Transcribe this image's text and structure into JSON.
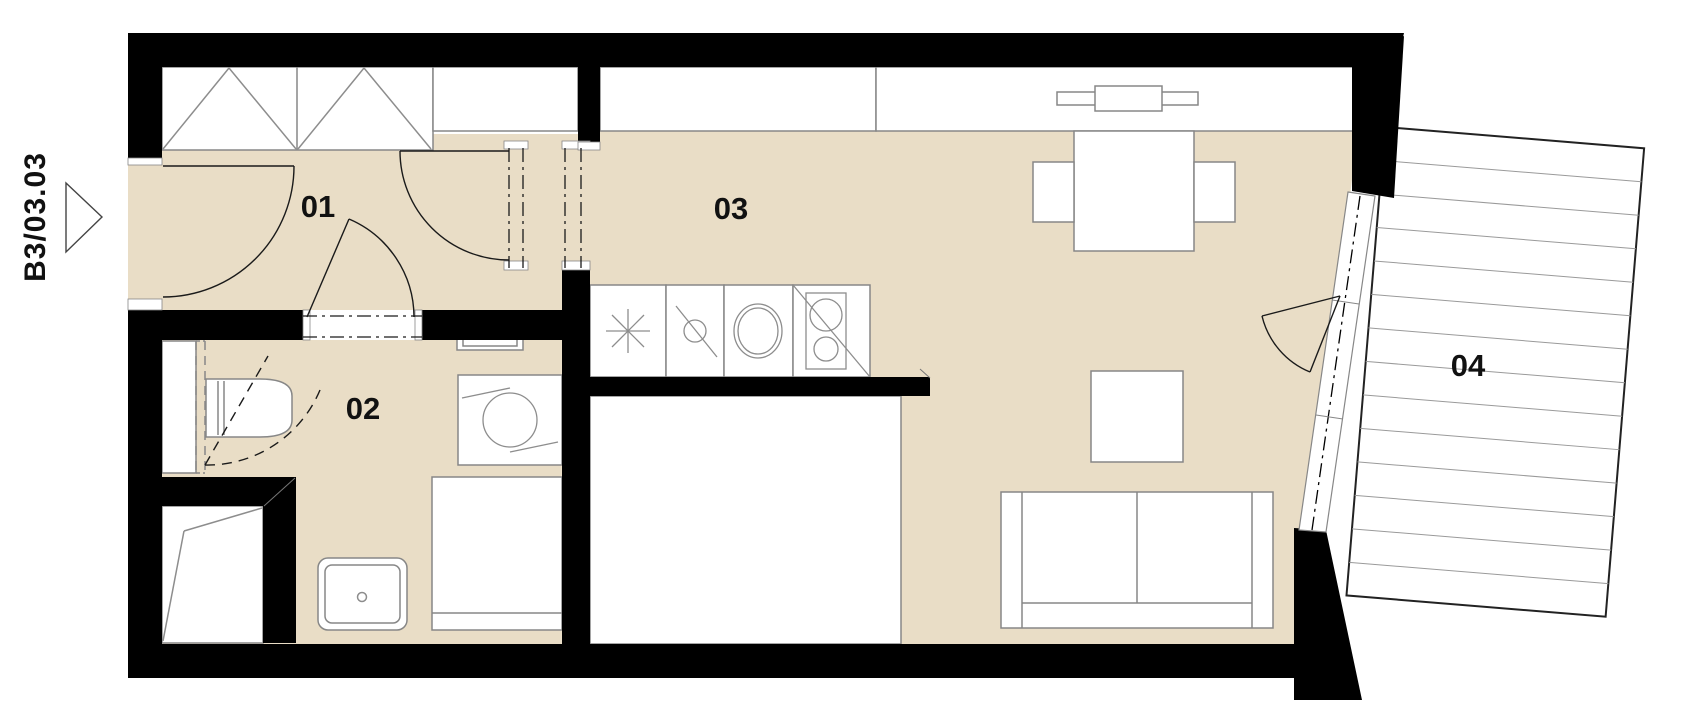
{
  "plan": {
    "unit_label": "B3/03.03",
    "rooms": [
      {
        "label": "01"
      },
      {
        "label": "02"
      },
      {
        "label": "03"
      },
      {
        "label": "04"
      }
    ],
    "colors": {
      "floor": "#e9ddc6",
      "wall": "#000000",
      "furniture_outline": "#878787",
      "balcony_deck_line": "#9a9a9a",
      "background": "#ffffff",
      "label_text": "#111111"
    },
    "icons": [
      "entrance-arrow-icon",
      "wardrobe-cross-icon",
      "window-icon",
      "fridge-asterisk-icon",
      "dishwasher-icon",
      "round-sink-icon",
      "hob-icon",
      "washing-machine-icon",
      "toilet-icon",
      "washbasin-icon",
      "towel-rail-icon",
      "shower-icon",
      "duct-hatch-icon"
    ]
  }
}
